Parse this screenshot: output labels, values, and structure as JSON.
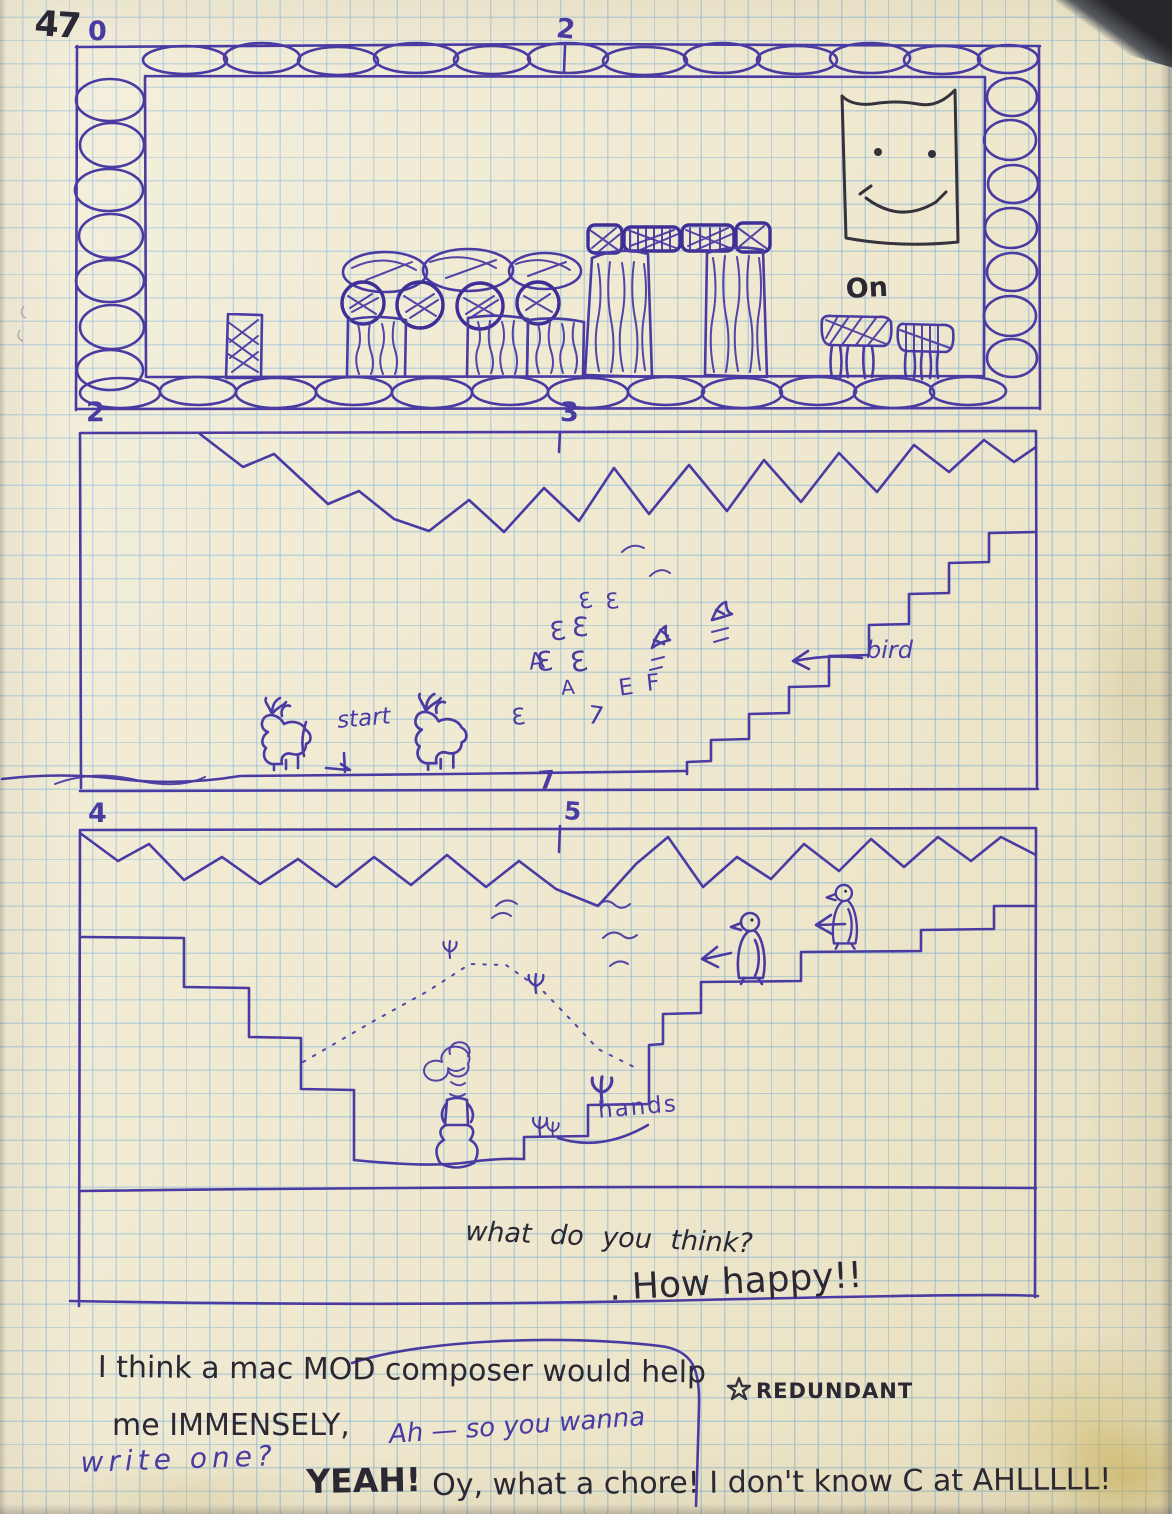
{
  "page": {
    "number": "47",
    "paper_color": "#efe9d2",
    "grid_color": "#76aed6",
    "pen_color": "#4a3ba2",
    "ink_color": "#2b2833"
  },
  "level_markers": {
    "top_left": "0",
    "top_mid": "2",
    "mid_left": "2",
    "mid_mid": "3",
    "divider": "7",
    "bottom_left": "4",
    "bottom_mid": "5"
  },
  "sketch_labels": {
    "on": "On",
    "bird": "bird",
    "start": "start",
    "hands": "hands"
  },
  "flock_glyphs": [
    "3",
    "3",
    "3",
    "3",
    "A",
    "3",
    "3",
    "A",
    "E",
    "F",
    "3",
    "7"
  ],
  "notes": {
    "question": "what do you think?",
    "exclaim": ". How happy!!",
    "line1": "I think a mac MOD composer would help",
    "line2": "me IMMENSELY,",
    "redundant": "REDUNDANT",
    "reply_blue_1": "Ah — so you wanna",
    "reply_blue_2": "write one?",
    "final_yeah": "YEAH!",
    "final_rest": "Oy, what a chore!  I don't know C at AHLLLLL!"
  }
}
